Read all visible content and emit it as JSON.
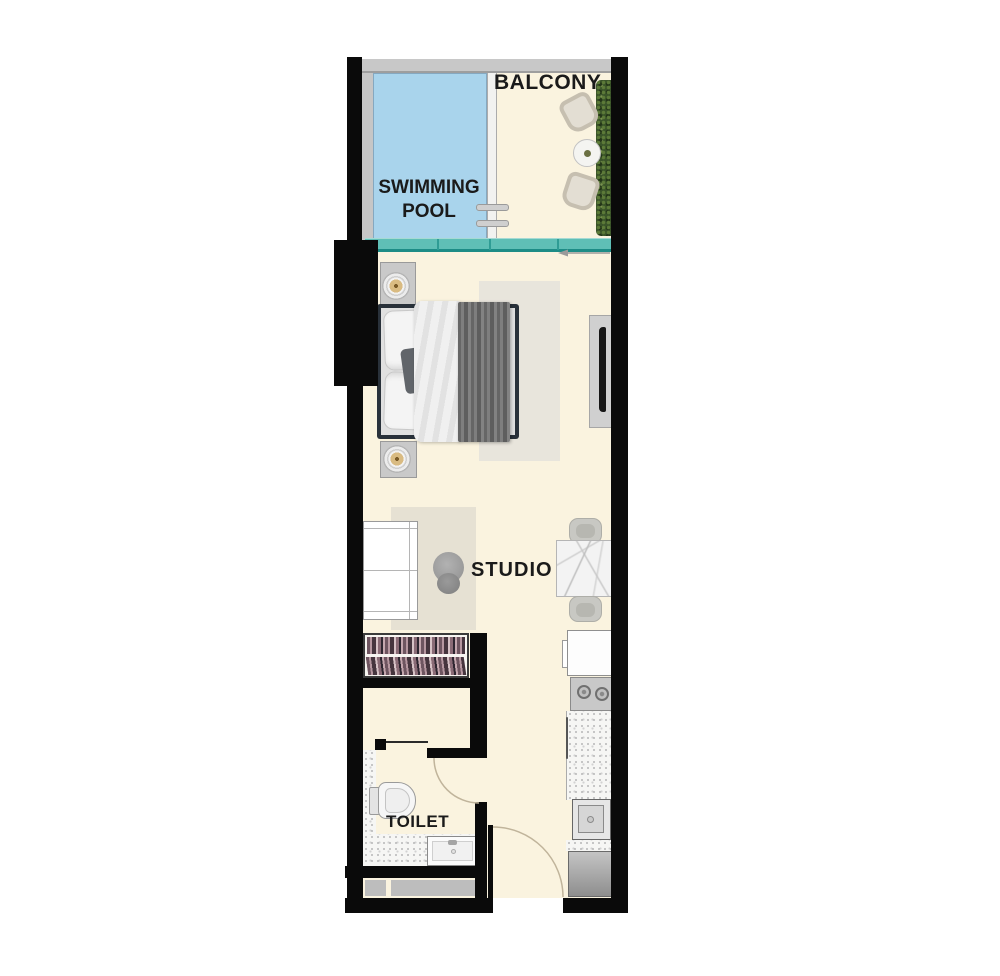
{
  "title": "Studio apartment floor plan",
  "labels": {
    "balcony": "BALCONY",
    "swimming_pool_line1": "SWIMMING",
    "swimming_pool_line2": "POOL",
    "studio": "STUDIO",
    "toilet": "TOILET"
  },
  "colors": {
    "wall": "#0a0a0a",
    "floor": "#FAF3DF",
    "pool-water": "#A9D4EC",
    "pool-edge": "#85A8C0",
    "glass-teal": "#5FBFB6",
    "glass-teal-dark": "#1D8C86",
    "railing-gray": "#C8C8C8",
    "rug-bedroom": "#E8E5DC",
    "rug-studio": "#E6E1D3",
    "blanket-gray": "#747474",
    "hedge-green": "#3A5429",
    "arc-line": "#C0B49B",
    "label-text": "#1a1a1a"
  },
  "rooms": [
    {
      "name": "Swimming Pool",
      "label": "SWIMMING POOL",
      "features": [
        "pool-water",
        "pool-ladder"
      ]
    },
    {
      "name": "Balcony",
      "label": "BALCONY",
      "features": [
        "lounge-chair",
        "round-side-table",
        "lounge-chair",
        "hedge-planter",
        "glass-balustrade"
      ]
    },
    {
      "name": "Studio",
      "label": "STUDIO",
      "features": [
        "double-bed",
        "nightstand-lamp",
        "nightstand-lamp",
        "bedroom-rug",
        "tv-unit",
        "desk",
        "desk-chair",
        "studio-rug",
        "marble-dining-table",
        "dining-chair",
        "dining-chair",
        "wardrobe",
        "fridge",
        "stove-two-burners",
        "kitchen-counter",
        "kitchen-sink",
        "washing-machine",
        "entry-door"
      ]
    },
    {
      "name": "Toilet",
      "label": "TOILET",
      "features": [
        "toilet-bowl",
        "vanity-sink",
        "tiled-floor",
        "toilet-door"
      ]
    }
  ]
}
